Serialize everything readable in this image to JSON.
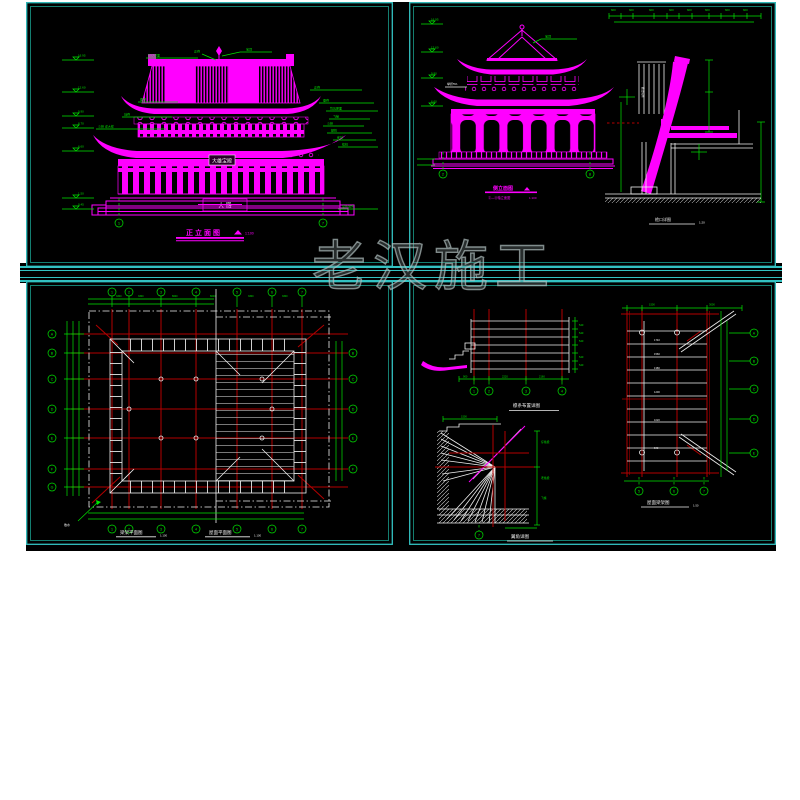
{
  "watermark": "老汉施工",
  "colors": {
    "sheet_bg": "#000000",
    "border_cyan": "#33c2c2",
    "border_inner": "#1a9e8c",
    "magenta": "#ff00ff",
    "green": "#00e400",
    "red": "#b40000",
    "white": "#efefef"
  },
  "s1": {
    "title": "正立面图",
    "scale": "1:100",
    "plaque": "大雄宝殿",
    "door_plaque": "大 殿",
    "levels": [
      "16.95",
      "12.60",
      "9.90",
      "8.70",
      "6.60",
      "1.50",
      "0.45"
    ],
    "leaders_top": [
      "筒瓦屋面",
      "正脊",
      "宝顶"
    ],
    "leaders_left": [
      "垂脊",
      "戗脊",
      "斗栱 详大样"
    ],
    "leaders_right": [
      "正脊",
      "垂脊",
      "筒瓦屋面",
      "飞椽",
      "斗栱",
      "额枋",
      "雀替",
      "檐柱",
      "室外地坪"
    ],
    "bubbles": [
      "1",
      "7"
    ]
  },
  "s2": {
    "title": "侧立面图",
    "sub": "②—⑧轴立面图",
    "scale": "1:100",
    "leader_top": "宝顶",
    "slope_note": "举折5%",
    "levels": [
      "16.95",
      "12.60",
      "9.90",
      "6.60"
    ],
    "bubbles": [
      "2",
      "8"
    ],
    "dims_top": [
      "600",
      "600",
      "600",
      "600",
      "600",
      "600",
      "600",
      "600"
    ],
    "notes_col": "做法说明",
    "detail_title": "檐口详图",
    "detail_scale": "1:20"
  },
  "s3": {
    "title_left": "梁架平面图",
    "title_right": "屋面平面图",
    "scale": "1:100",
    "bubbles_top": [
      "1",
      "2",
      "3",
      "4",
      "5",
      "6",
      "7"
    ],
    "bubbles_bottom": [
      "1",
      "2",
      "3",
      "4",
      "5",
      "6",
      "7"
    ],
    "bubbles_left": [
      "A",
      "B",
      "C",
      "D",
      "E",
      "F",
      "G"
    ],
    "bubbles_right": [
      "B",
      "C",
      "D",
      "E",
      "F"
    ],
    "dims_top": [
      "3300",
      "3300",
      "6600",
      "6600",
      "3300",
      "3300"
    ],
    "corner_note": "散水"
  },
  "s4": {
    "a_title": "檩条布置详图",
    "a_dims": [
      "540",
      "540",
      "540",
      "540",
      "540"
    ],
    "a_dims_b": [
      "900",
      "2220",
      "2160"
    ],
    "a_bubbles": [
      "1",
      "2",
      "3",
      "4"
    ],
    "b_title": "翼角详图",
    "b_bubble": "7",
    "b_labels": [
      "仔角梁",
      "老角梁",
      "飞椽"
    ],
    "b_dim": "1500",
    "c_title": "屋面梁架图",
    "c_scale": "1:50",
    "c_cells": [
      "1740",
      "1560",
      "1380",
      "1200",
      "1020",
      "840"
    ],
    "c_bubbles_right": [
      "A",
      "B",
      "C",
      "D",
      "E"
    ],
    "c_bubbles_bottom": [
      "5",
      "6",
      "7"
    ],
    "c_dims_top": [
      "1500",
      "3000"
    ]
  }
}
